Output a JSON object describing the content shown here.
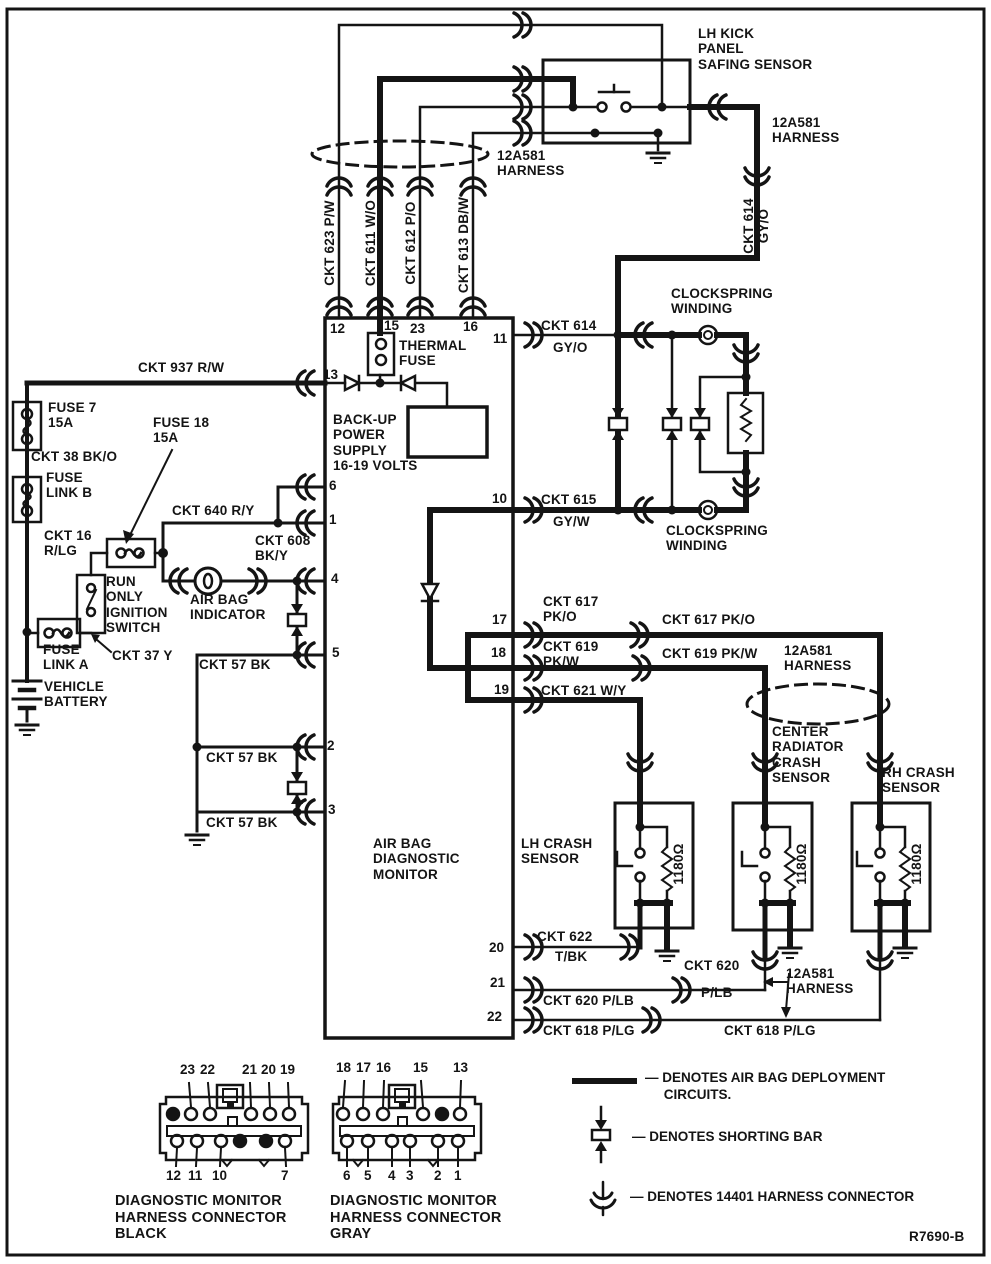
{
  "labels": {
    "lh_kick_panel": "LH KICK\nPANEL\nSAFING SENSOR",
    "harness": "12A581\nHARNESS",
    "ckt614_vertical": "CKT 614\nGY/O",
    "ckt623": "CKT 623 P/W",
    "ckt611": "CKT 611 W/O",
    "ckt612": "CKT 612 P/O",
    "ckt613": "CKT 613 DB/W",
    "thermal_fuse": "THERMAL\nFUSE",
    "ckt937": "CKT 937 R/W",
    "fuse7": "FUSE 7\n15A",
    "fuse18": "FUSE 18\n15A",
    "ckt38": "CKT 38 BK/O",
    "fuse_link_b": "FUSE\nLINK B",
    "ckt16": "CKT 16\nR/LG",
    "backup_power": "BACK-UP\nPOWER\nSUPPLY\n16-19 VOLTS",
    "ckt640": "CKT 640 R/Y",
    "ckt608": "CKT 608\nBK/Y",
    "run_only_ignition": "RUN\nONLY\nIGNITION\nSWITCH",
    "air_bag_indicator": "AIR BAG\nINDICATOR",
    "fuse_link_a": "FUSE\nLINK A",
    "ckt37": "CKT 37 Y",
    "vehicle_battery": "VEHICLE\nBATTERY",
    "ckt614_name": "CKT 614",
    "ckt614_color": "GY/O",
    "ckt615_name": "CKT 615",
    "ckt615_color": "GY/W",
    "clockspring": "CLOCKSPRING\nWINDING",
    "ckt617_pair": "CKT 617\nPK/O",
    "ckt619_pair": "CKT 619\nPK/W",
    "ckt617_long": "CKT 617 PK/O",
    "ckt619_long": "CKT 619 PK/W",
    "ckt621": "CKT 621 W/Y",
    "center_radiator": "CENTER\nRADIATOR\nCRASH\nSENSOR",
    "rh_crash": "RH CRASH\nSENSOR",
    "lh_crash": "LH CRASH\nSENSOR",
    "monitor": "AIR BAG\nDIAGNOSTIC\nMONITOR",
    "r1180": "1180Ω",
    "ckt622_name": "CKT 622",
    "ckt622_color": "T/BK",
    "ckt57": "CKT 57 BK",
    "ckt620_name": "CKT 620",
    "ckt620_color": "P/LB",
    "ckt620_long": "CKT 620 P/LB",
    "ckt618_long": "CKT 618 P/LG",
    "connector_black": "DIAGNOSTIC MONITOR\nHARNESS CONNECTOR\nBLACK",
    "connector_gray": "DIAGNOSTIC MONITOR\nHARNESS CONNECTOR\nGRAY",
    "ref": "R7690-B"
  },
  "pins": {
    "p1": "1",
    "p2": "2",
    "p3": "3",
    "p4": "4",
    "p5": "5",
    "p6": "6",
    "p10": "10",
    "p11": "11",
    "p12": "12",
    "p13": "13",
    "p15": "15",
    "p16": "16",
    "p17": "17",
    "p18": "18",
    "p19": "19",
    "p20": "20",
    "p21": "21",
    "p22": "22",
    "p23": "23"
  },
  "connector_black_pins": {
    "top": [
      "23",
      "22",
      "21",
      "20",
      "19"
    ],
    "bottom": [
      "12",
      "11",
      "10",
      "7"
    ]
  },
  "connector_gray_pins": {
    "top": [
      "18",
      "17",
      "16",
      "15",
      "13"
    ],
    "bottom": [
      "6",
      "5",
      "4",
      "3",
      "2",
      "1"
    ]
  },
  "legend": {
    "deployment": "— DENOTES AIR BAG DEPLOYMENT\n     CIRCUITS.",
    "shorting_bar": "— DENOTES SHORTING BAR",
    "harness_connector": "— DENOTES 14401 HARNESS CONNECTOR"
  },
  "colors": {
    "ink": "#141414",
    "paper": "#ffffff"
  }
}
